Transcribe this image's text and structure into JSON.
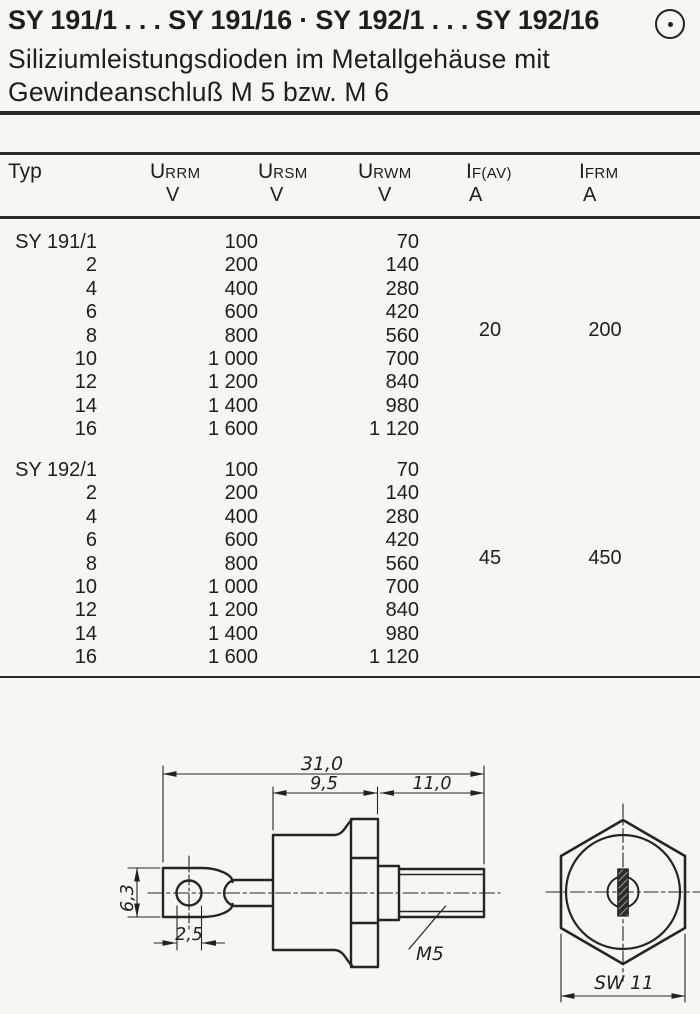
{
  "header": {
    "title": "SY 191/1 . . . SY 191/16 · SY 192/1 . . . SY 192/16",
    "brand_icon": "circle-dot-icon",
    "subtitle_line1": "Siliziumleistungsdioden im Metallgehäuse mit",
    "subtitle_line2": "Gewindeanschluß M 5 bzw. M 6"
  },
  "colors": {
    "ink": "#24221c",
    "paper": "#f7f6f1"
  },
  "table": {
    "columns": [
      {
        "label": "Typ",
        "unit": ""
      },
      {
        "main": "U",
        "sub": "RRM",
        "unit": "V"
      },
      {
        "main": "U",
        "sub": "RSM",
        "unit": "V"
      },
      {
        "main": "U",
        "sub": "RWM",
        "unit": "V"
      },
      {
        "main": "I",
        "sub": "F(AV)",
        "unit": "A"
      },
      {
        "main": "I",
        "sub": "FRM",
        "unit": "A"
      }
    ],
    "groups": [
      {
        "typ": [
          "SY 191/1",
          "2",
          "4",
          "6",
          "8",
          "10",
          "12",
          "14",
          "16"
        ],
        "urrm": [
          "100",
          "200",
          "400",
          "600",
          "800",
          "1 000",
          "1 200",
          "1 400",
          "1 600"
        ],
        "urwm": [
          "70",
          "140",
          "280",
          "420",
          "560",
          "700",
          "840",
          "980",
          "1 120"
        ],
        "if_av": "20",
        "ifrm": "200"
      },
      {
        "typ": [
          "SY 192/1",
          "2",
          "4",
          "6",
          "8",
          "10",
          "12",
          "14",
          "16"
        ],
        "urrm": [
          "100",
          "200",
          "400",
          "600",
          "800",
          "1 000",
          "1 200",
          "1 400",
          "1 600"
        ],
        "urwm": [
          "70",
          "140",
          "280",
          "420",
          "560",
          "700",
          "840",
          "980",
          "1 120"
        ],
        "if_av": "45",
        "ifrm": "450"
      }
    ]
  },
  "drawing": {
    "overall_length": "31,0",
    "case_length": "9,5",
    "stud_length": "11,0",
    "lug_width": "6,3",
    "hole_diameter": "2,5",
    "thread_label": "M5",
    "wrench_size": "SW 11"
  }
}
